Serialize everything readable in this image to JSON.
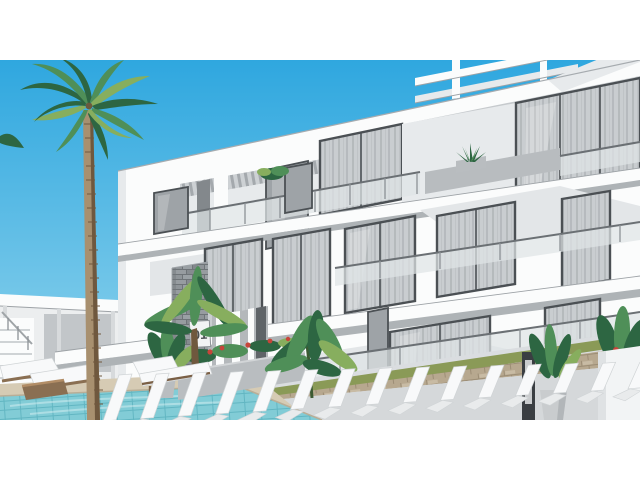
{
  "scene": {
    "type": "3d-architectural-rendering",
    "description": "Exterior render of a modern white three-storey apartment building with glass balconies, curtained sliding windows, palm trees, tropical plants, a turquoise swimming pool and rows of white sun loungers",
    "unit_number": "01"
  },
  "pool": {
    "lounger_count": 15,
    "wooden_lounger_count": 3
  },
  "colors": {
    "sky_top": "#2fa7df",
    "sky_horizon": "#97d7ee",
    "building_white": "#fbfcfc",
    "building_shade": "#e7eaec",
    "slab_underside": "#aeb3b6",
    "under_roof_shadow": "#c6cacd",
    "window_frame": "#4b5054",
    "curtain_light": "#c9cdd0",
    "glass_tint": "#9ea3a7",
    "railing_glass": "#dfe4e6",
    "stone_dark": "#7f8488",
    "palm_green_dark": "#2d6642",
    "palm_green": "#4f8f58",
    "palm_green_light": "#87ae5e",
    "trunk_brown": "#a8906f",
    "trunk_shade": "#6f583e",
    "pool_water": "#82ccd6",
    "pool_tile": "#62b6c2",
    "deck_beige": "#d6cbb4",
    "path_tan": "#b7a88f",
    "grass_green": "#8a9a57",
    "flower_red": "#c6453a",
    "lounger_white": "#f8f9fa",
    "wood_brown": "#8a6f52",
    "planter_gray": "#b9bdc0",
    "lamp_black": "#3a3e42"
  }
}
